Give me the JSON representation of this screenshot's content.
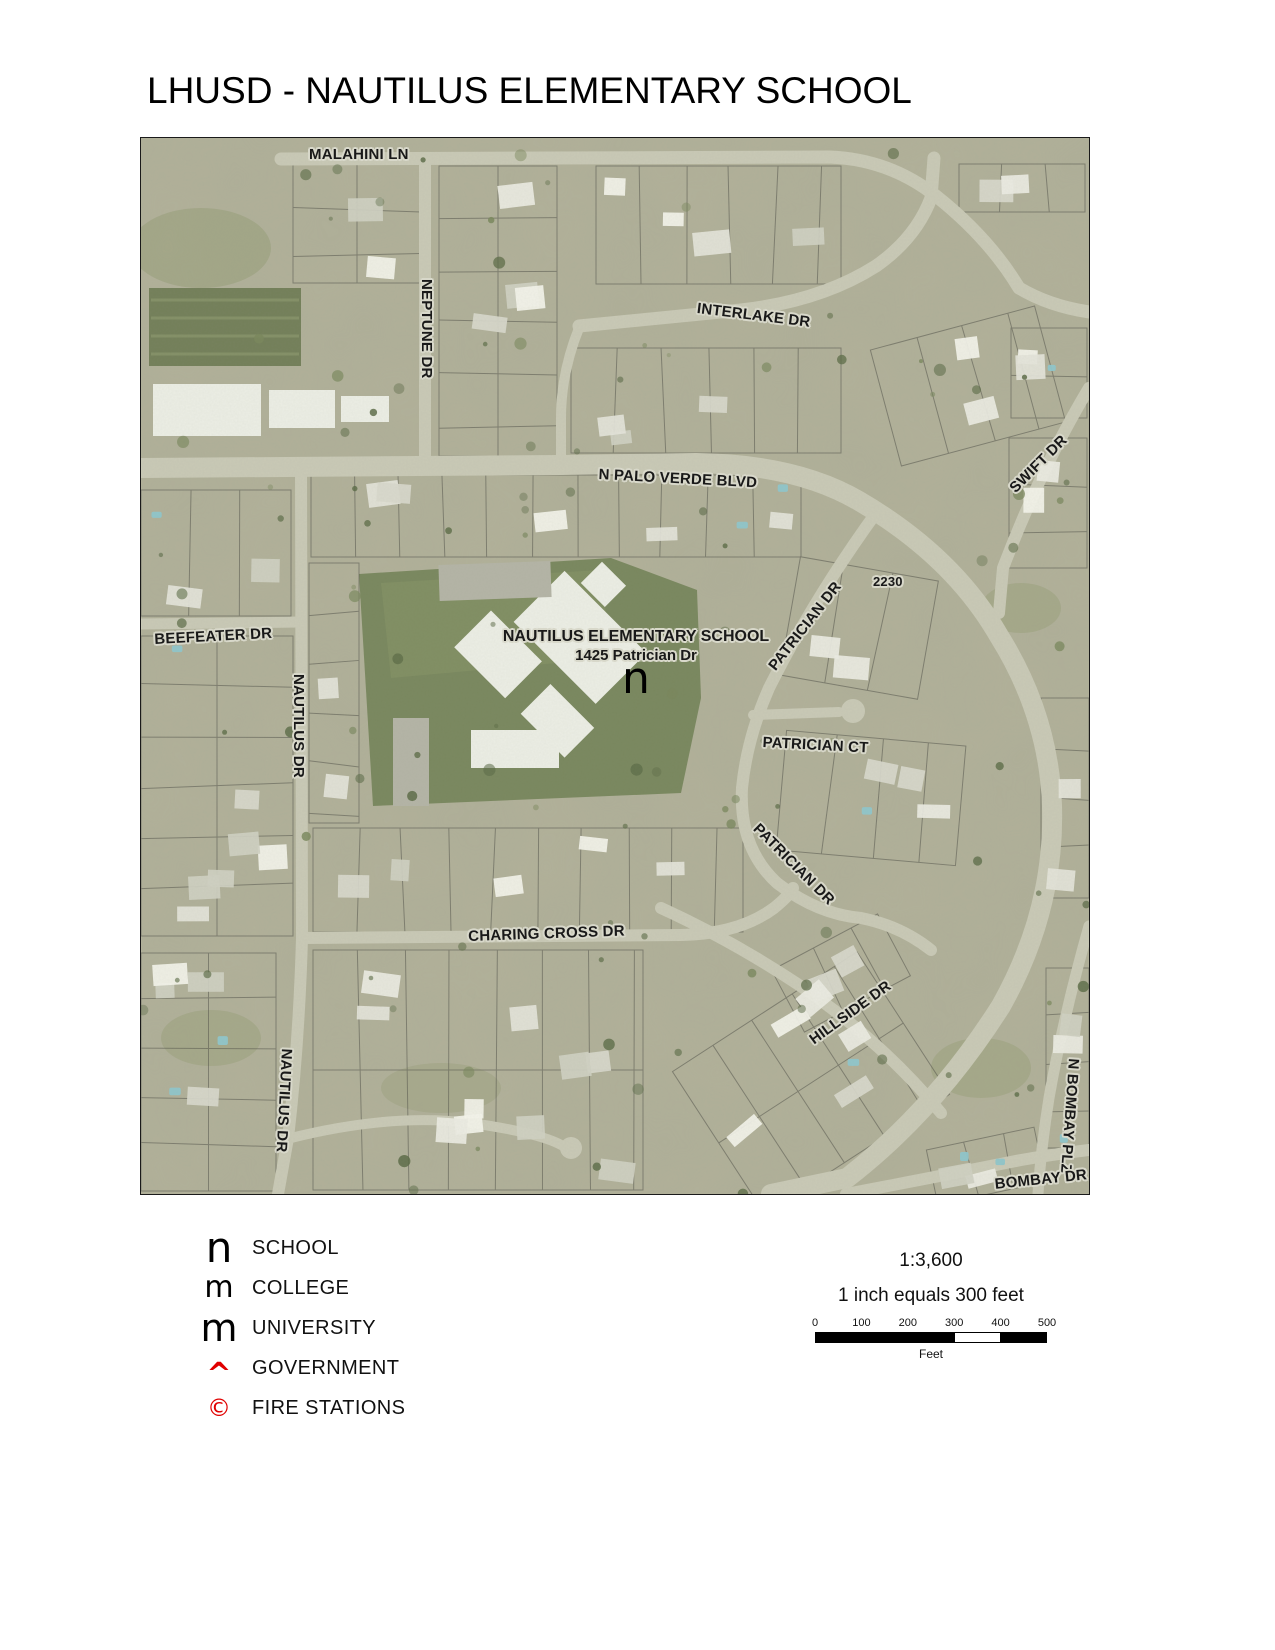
{
  "title": "LHUSD - NAUTILUS ELEMENTARY SCHOOL",
  "map": {
    "labels": [
      {
        "text": "MALAHINI LN",
        "x": 168,
        "y": 9,
        "rot": 0,
        "size": 15
      },
      {
        "text": "NEPTUNE DR",
        "x": 293,
        "y": 141,
        "rot": 90,
        "size": 15
      },
      {
        "text": "INTERLAKE DR",
        "x": 557,
        "y": 163,
        "rot": 7,
        "size": 15
      },
      {
        "text": "N PALO VERDE BLVD",
        "x": 458,
        "y": 329,
        "rot": 3,
        "size": 15
      },
      {
        "text": "SWIFT DR",
        "x": 866,
        "y": 347,
        "rot": -45,
        "size": 15
      },
      {
        "text": "2230",
        "x": 732,
        "y": 437,
        "rot": 0,
        "size": 13
      },
      {
        "text": "PATRICIAN DR",
        "x": 625,
        "y": 526,
        "rot": -52,
        "size": 15
      },
      {
        "text": "PATRICIAN CT",
        "x": 622,
        "y": 597,
        "rot": 3,
        "size": 15
      },
      {
        "text": "BEEFEATER DR",
        "x": 13,
        "y": 494,
        "rot": -3,
        "size": 15
      },
      {
        "text": "NAUTILUS DR",
        "x": 165,
        "y": 536,
        "rot": 90,
        "size": 15
      },
      {
        "text": "PATRICIAN DR",
        "x": 620,
        "y": 683,
        "rot": 45,
        "size": 15
      },
      {
        "text": "CHARING CROSS DR",
        "x": 327,
        "y": 791,
        "rot": -2,
        "size": 15
      },
      {
        "text": "HILLSIDE DR",
        "x": 666,
        "y": 897,
        "rot": -36,
        "size": 15
      },
      {
        "text": "NAUTILUS DR",
        "x": 153,
        "y": 911,
        "rot": 93,
        "size": 15
      },
      {
        "text": "N BOMBAY PLZ",
        "x": 940,
        "y": 921,
        "rot": 94,
        "size": 15
      },
      {
        "text": "BOMBAY DR",
        "x": 853,
        "y": 1039,
        "rot": -6,
        "size": 15
      }
    ],
    "school": {
      "name": "NAUTILUS ELEMENTARY SCHOOL",
      "address": "1425 Patrician Dr",
      "symbol": "n"
    }
  },
  "legend": {
    "items": [
      {
        "symbol": "n",
        "label": "SCHOOL",
        "color": "#000000",
        "symbol_size": 42
      },
      {
        "symbol": "m",
        "label": "COLLEGE",
        "color": "#000000",
        "symbol_size": 30
      },
      {
        "symbol": "m",
        "label": "UNIVERSITY",
        "color": "#000000",
        "symbol_size": 38
      },
      {
        "symbol": "^",
        "label": "GOVERNMENT",
        "color": "#e00000",
        "symbol_size": 30
      },
      {
        "symbol": "©",
        "label": "FIRE STATIONS",
        "color": "#e00000",
        "symbol_size": 24
      }
    ]
  },
  "scale": {
    "ratio": "1:3,600",
    "equivalence": "1 inch equals 300 feet",
    "ticks": [
      "0",
      "100",
      "200",
      "300",
      "400",
      "500"
    ],
    "unit": "Feet",
    "bar_colors": [
      "#000000",
      "#000000",
      "#000000",
      "#ffffff",
      "#000000"
    ]
  }
}
